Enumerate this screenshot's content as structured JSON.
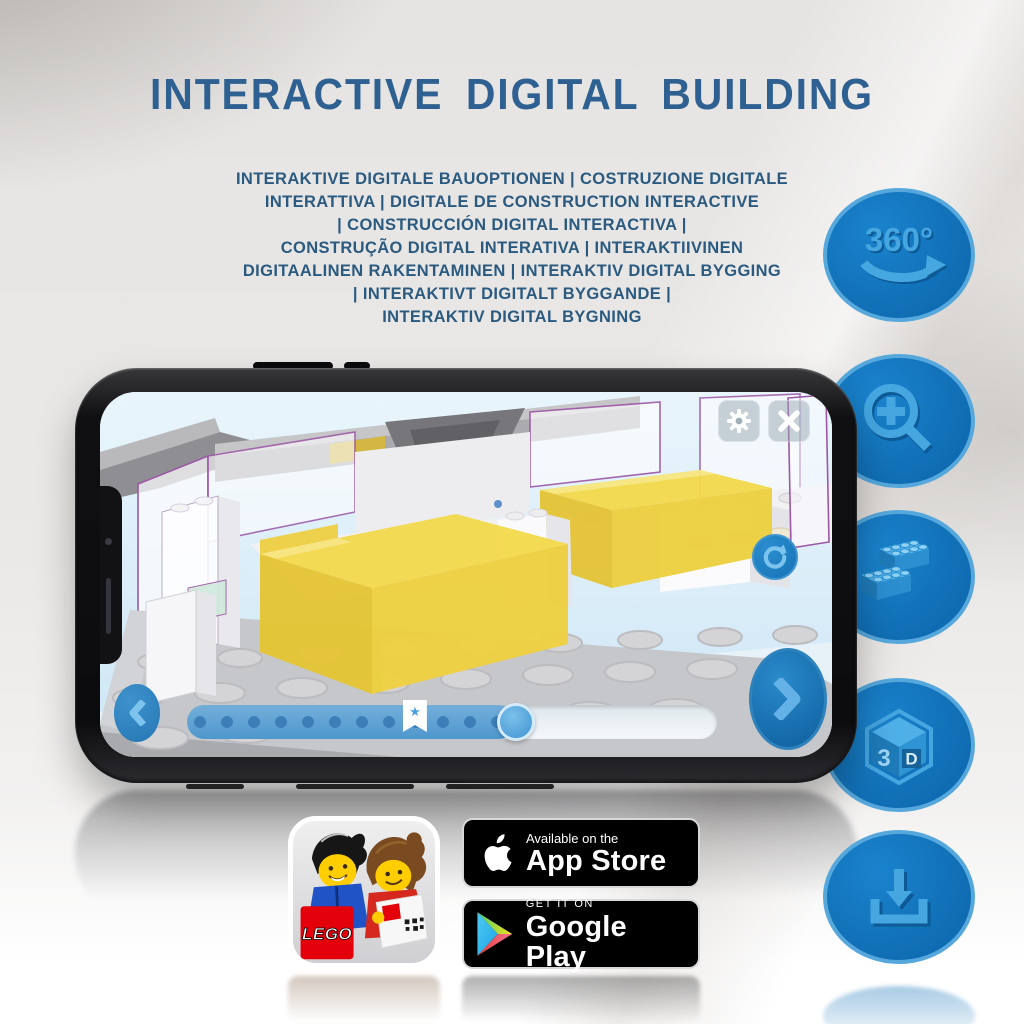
{
  "title": "INTERACTIVE DIGITAL BUILDING",
  "subtitle": {
    "lines": [
      "INTERAKTIVE DIGITALE BAUOPTIONEN | COSTRUZIONE DIGITALE",
      "INTERATTIVA | DIGITALE DE CONSTRUCTION INTERACTIVE",
      "| CONSTRUCCIÓN DIGITAL INTERACTIVA |",
      "CONSTRUÇÃO DIGITAL INTERATIVA | INTERAKTIIVINEN",
      "DIGITAALINEN RAKENTAMINEN | INTERAKTIV DIGITAL BYGGING",
      "| INTERAKTIVT DIGITALT BYGGANDE |",
      "INTERAKTIV DIGITAL BYGNING"
    ]
  },
  "feature_icons": {
    "rotation_label": "360°",
    "cube_left": "3",
    "cube_right": "D"
  },
  "phone_app": {
    "slider": {
      "progress_percent": 62,
      "marker_percent": 43
    }
  },
  "store": {
    "app_store": {
      "line1": "Available on the",
      "line2": "App Store"
    },
    "google_play": {
      "line1": "GET IT ON",
      "line2": "Google Play"
    },
    "app_icon_logo": "LEGO"
  },
  "colors": {
    "title_blue": "#2e6191",
    "subtitle_blue": "#2a5a80",
    "circle_blue": "#1273ba",
    "circle_rim": "#56a8dc",
    "glyph_blue": "#45a6e0",
    "screen_bg": "#d9edf9",
    "ui_button_blue": "#1b80c4",
    "bed_yellow": "#f2d84b",
    "outline_purple": "#9c57a5",
    "lego_red": "#e3000b",
    "badge_black": "#000000"
  }
}
